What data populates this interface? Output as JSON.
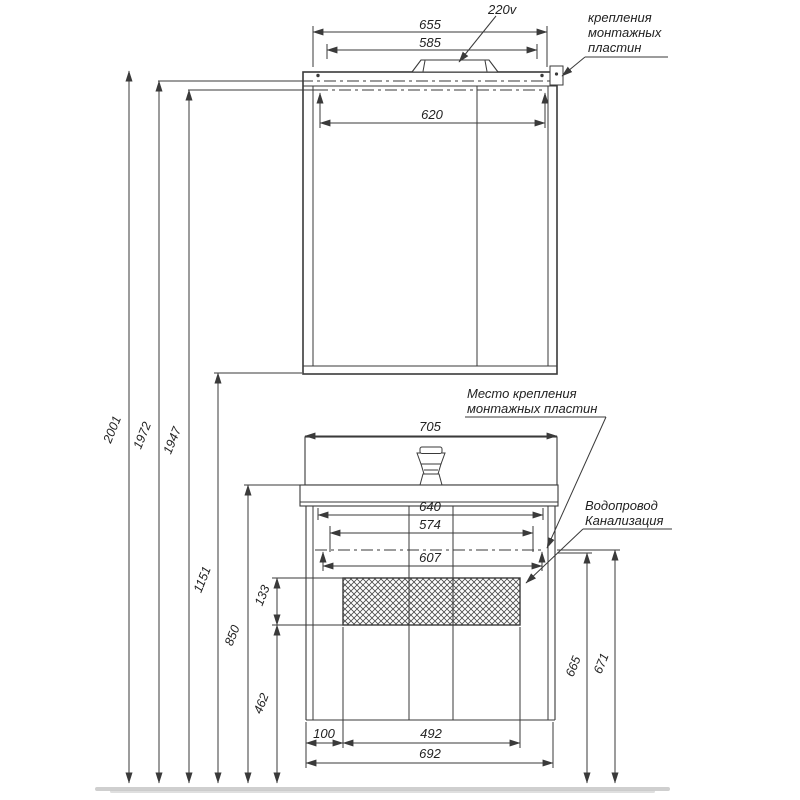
{
  "labels": {
    "voltage": "220v",
    "mirror_mount": [
      "крепления",
      "монтажных",
      "пластин"
    ],
    "vanity_mount": [
      "Место крепления",
      "монтажных пластин"
    ],
    "plumbing": [
      "Водопровод",
      "Канализация"
    ]
  },
  "dimensions": {
    "mirror": {
      "overall_width": "655",
      "lamp_width": "585",
      "mount_width": "620"
    },
    "heights": {
      "total": "2001",
      "upper_mount": "1972",
      "lower_mount": "1947",
      "mirror_bottom": "1151",
      "sink_top": "850",
      "service_zone_height": "133",
      "service_zone_bottom": "462"
    },
    "vanity": {
      "sink_width": "705",
      "inner_width": "640",
      "rail_width": "574",
      "mount_width": "607",
      "service_offset": "100",
      "service_width": "492",
      "cabinet_width": "692"
    },
    "plumbing": {
      "water_height": "665",
      "drain_height": "671"
    }
  }
}
